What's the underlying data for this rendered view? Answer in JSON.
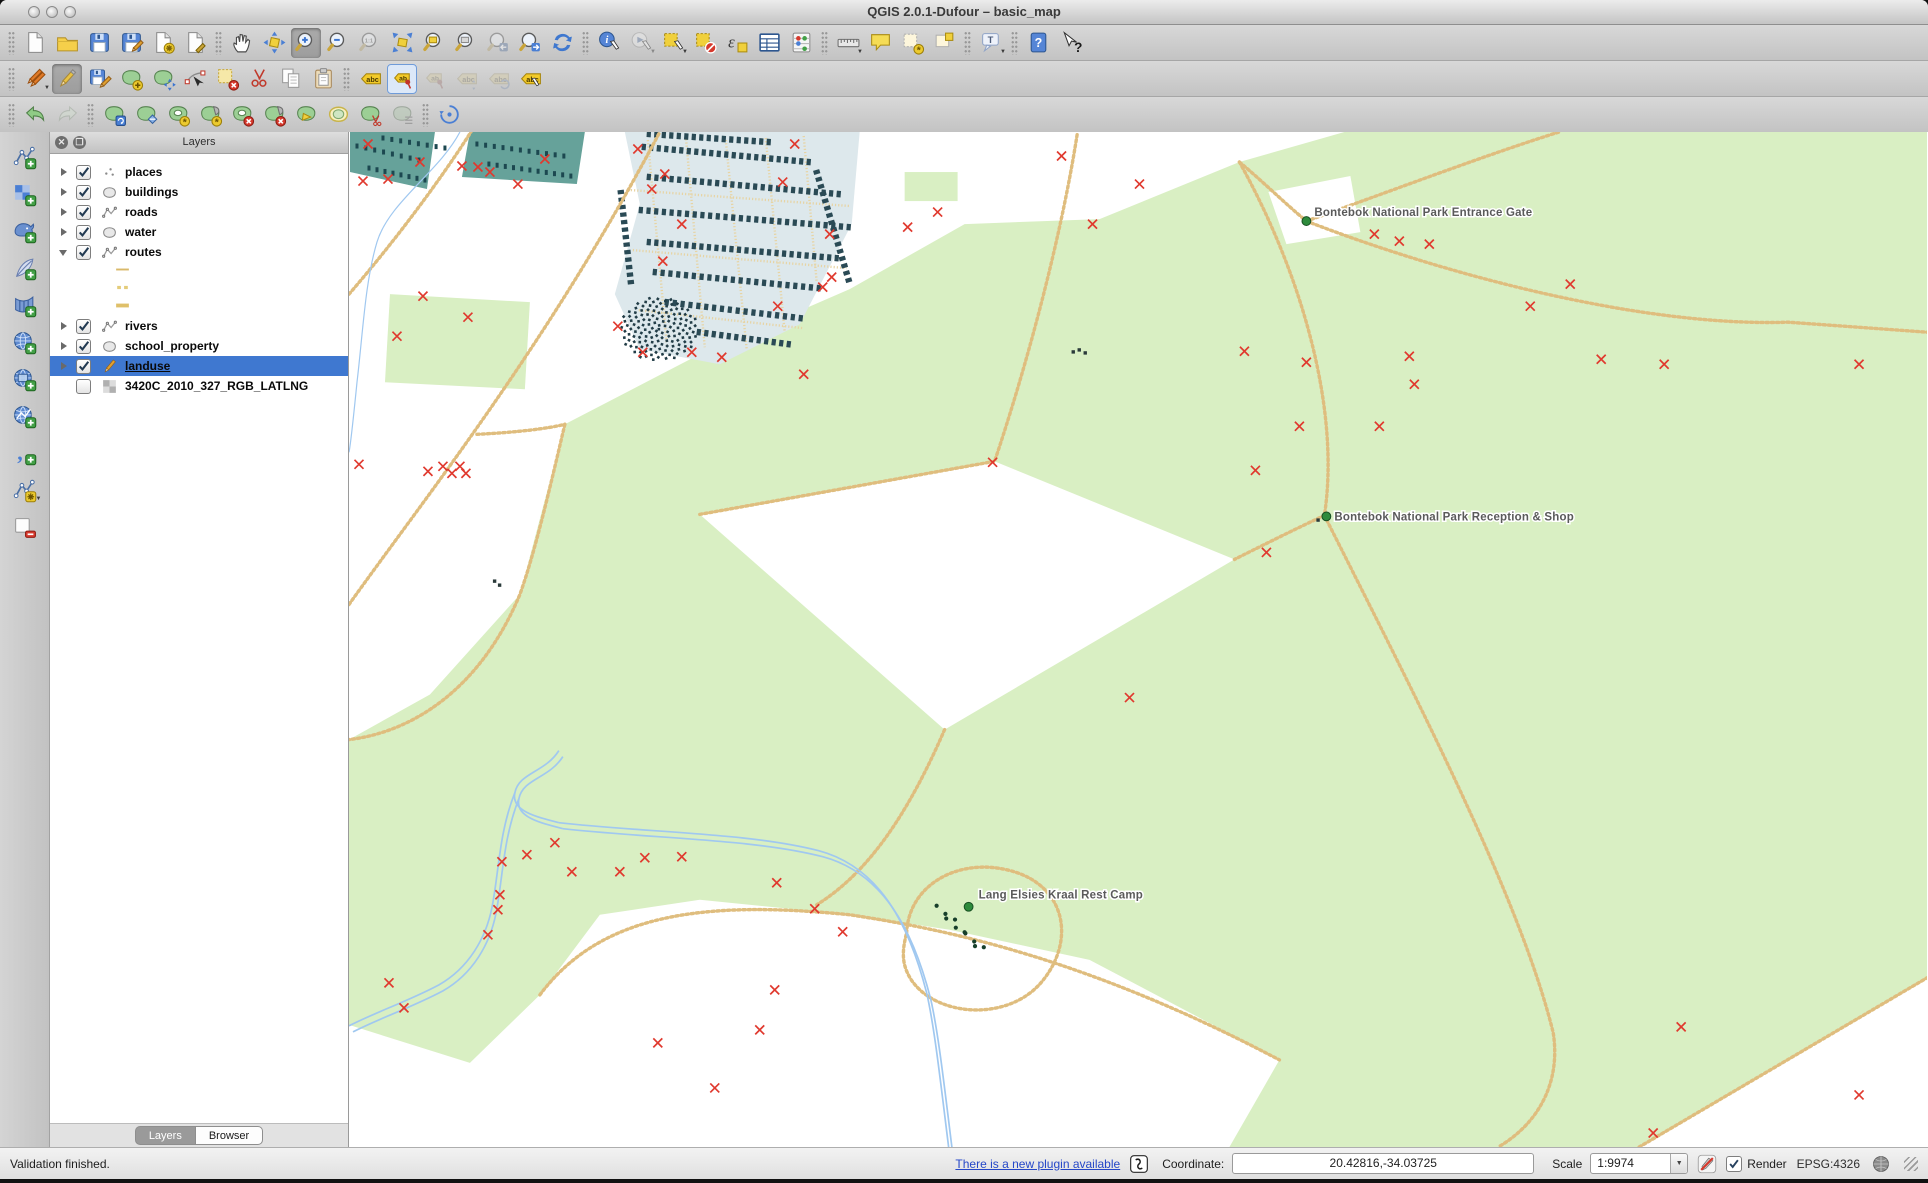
{
  "window": {
    "title": "QG­IS 2.0.1-Dufour – basic_map"
  },
  "toolbars": {
    "row1": [
      "|",
      "new-project",
      "open-project",
      "save-project",
      "save-project-as",
      "new-print-composer",
      "composer-manager",
      "|",
      "pan-map",
      "pan-to-selection",
      "zoom-in",
      "zoom-out",
      "zoom-actual-size",
      "zoom-full-extent",
      "zoom-to-selection",
      "zoom-to-layer",
      "zoom-last",
      "zoom-next",
      "refresh-map",
      "|",
      "identify-features",
      "run-feature-action",
      "select-features",
      "deselect-features",
      "select-by-expression",
      "open-attribute-table",
      "field-calculator",
      "|",
      "measure-line",
      "map-tips",
      "new-bookmark",
      "show-bookmarks",
      "|",
      "text-annotation",
      "|",
      "help-contents",
      "whats-this"
    ],
    "row2": [
      "|",
      "current-edits",
      "toggle-editing",
      "save-layer-edits",
      "add-feature",
      "move-feature",
      "node-tool",
      "delete-selected",
      "cut-features",
      "copy-features",
      "paste-features",
      "|",
      "labeling-options",
      "pin-unpin-labels",
      "highlight-pinned-labels",
      "move-label",
      "rotate-label",
      "change-label"
    ],
    "row3": [
      "|",
      "undo",
      "redo",
      "|",
      "rotate-feature",
      "simplify-feature",
      "add-ring",
      "add-part",
      "delete-ring",
      "delete-part",
      "reshape-features",
      "offset-curve",
      "split-features",
      "merge-features",
      "|",
      "rotate-point-symbols"
    ],
    "left": [
      "add-vector-layer",
      "add-raster-layer",
      "add-postgis-layer",
      "add-spatialite-layer",
      "add-mssql-layer",
      "add-wms-layer",
      "add-wcs-layer",
      "add-wfs-layer",
      "add-delimited-text-layer",
      "new-shapefile-layer",
      "remove-layer"
    ],
    "states": {
      "pressed": [
        "zoom-in",
        "toggle-editing"
      ],
      "framed": [
        "pin-unpin-labels"
      ],
      "disabled": [
        "zoom-actual-size",
        "zoom-last",
        "run-feature-action",
        "highlight-pinned-labels",
        "move-label",
        "rotate-label",
        "redo",
        "merge-features"
      ],
      "dropdown": [
        "current-edits",
        "run-feature-action",
        "select-features",
        "measure-line",
        "text-annotation",
        "new-shapefile-layer"
      ]
    }
  },
  "layers_panel": {
    "title": "Layers",
    "items": [
      {
        "label": "places",
        "checked": true,
        "arrow": "right",
        "symbol": "points"
      },
      {
        "label": "buildings",
        "checked": true,
        "arrow": "right",
        "symbol": "polygon"
      },
      {
        "label": "roads",
        "checked": true,
        "arrow": "right",
        "symbol": "line"
      },
      {
        "label": "water",
        "checked": true,
        "arrow": "right",
        "symbol": "polygon"
      },
      {
        "label": "routes",
        "checked": true,
        "arrow": "down",
        "symbol": "line",
        "children": [
          {
            "swatch": "thin"
          },
          {
            "swatch": "dashed"
          },
          {
            "swatch": "thick"
          }
        ]
      },
      {
        "label": "rivers",
        "checked": true,
        "arrow": "right",
        "symbol": "line"
      },
      {
        "label": "school_property",
        "checked": true,
        "arrow": "right",
        "symbol": "polygon"
      },
      {
        "label": "landuse",
        "checked": true,
        "arrow": "right",
        "symbol": "pencil",
        "selected": true
      },
      {
        "label": "3420C_2010_327_RGB_LATLNG",
        "checked": false,
        "symbol": "raster"
      }
    ],
    "tabs": [
      {
        "label": "Layers",
        "active": true
      },
      {
        "label": "Browser",
        "active": false
      }
    ]
  },
  "map": {
    "labels": [
      {
        "text": "Bontebok National Park Entrance Gate",
        "x": 966,
        "y": 84,
        "dot_x": 958,
        "dot_y": 89
      },
      {
        "text": "Bontebok National Park Reception & Shop",
        "x": 986,
        "y": 388,
        "dot_x": 978,
        "dot_y": 384
      },
      {
        "text": "Lang Elsies Kraal Rest Camp",
        "x": 630,
        "y": 766,
        "dot_x": 620,
        "dot_y": 774
      }
    ],
    "markers": [
      [
        19,
        12
      ],
      [
        14,
        49
      ],
      [
        39,
        47
      ],
      [
        71,
        30
      ],
      [
        113,
        34
      ],
      [
        129,
        35
      ],
      [
        141,
        40
      ],
      [
        169,
        52
      ],
      [
        196,
        27
      ],
      [
        74,
        164
      ],
      [
        119,
        185
      ],
      [
        48,
        204
      ],
      [
        289,
        17
      ],
      [
        316,
        42
      ],
      [
        303,
        57
      ],
      [
        333,
        92
      ],
      [
        314,
        129
      ],
      [
        269,
        194
      ],
      [
        294,
        220
      ],
      [
        343,
        220
      ],
      [
        373,
        225
      ],
      [
        429,
        174
      ],
      [
        434,
        50
      ],
      [
        446,
        12
      ],
      [
        481,
        102
      ],
      [
        474,
        155
      ],
      [
        483,
        145
      ],
      [
        10,
        332
      ],
      [
        79,
        339
      ],
      [
        94,
        334
      ],
      [
        103,
        341
      ],
      [
        111,
        334
      ],
      [
        117,
        341
      ],
      [
        455,
        242
      ],
      [
        644,
        330
      ],
      [
        781,
        565
      ],
      [
        918,
        420
      ],
      [
        559,
        95
      ],
      [
        589,
        80
      ],
      [
        713,
        24
      ],
      [
        744,
        92
      ],
      [
        791,
        52
      ],
      [
        1026,
        102
      ],
      [
        1051,
        109
      ],
      [
        1081,
        112
      ],
      [
        896,
        219
      ],
      [
        958,
        230
      ],
      [
        1061,
        224
      ],
      [
        1066,
        252
      ],
      [
        951,
        294
      ],
      [
        1031,
        294
      ],
      [
        1253,
        227
      ],
      [
        1316,
        232
      ],
      [
        1511,
        232
      ],
      [
        907,
        338
      ],
      [
        1182,
        174
      ],
      [
        1222,
        152
      ],
      [
        153,
        729
      ],
      [
        178,
        722
      ],
      [
        206,
        710
      ],
      [
        223,
        739
      ],
      [
        271,
        739
      ],
      [
        296,
        725
      ],
      [
        333,
        724
      ],
      [
        428,
        750
      ],
      [
        466,
        776
      ],
      [
        494,
        799
      ],
      [
        151,
        762
      ],
      [
        149,
        777
      ],
      [
        139,
        802
      ],
      [
        426,
        857
      ],
      [
        411,
        897
      ],
      [
        40,
        850
      ],
      [
        55,
        875
      ],
      [
        309,
        910
      ],
      [
        366,
        955
      ],
      [
        1333,
        894
      ],
      [
        1305,
        1000
      ],
      [
        1511,
        962
      ]
    ],
    "colors": {
      "park": "#d9efc3",
      "town": "#66a29a",
      "residential": "#dde8ec",
      "building": "#2a4a55",
      "road": "#dfbd7e",
      "street": "#e7d4a4",
      "river": "#a0c8f0",
      "marker": "#e0392e",
      "label": "#5a5a5a",
      "poi": "#2e8b3c",
      "selection": "#3f78d0"
    }
  },
  "status_bar": {
    "message": "Validation finished.",
    "plugin_link": "There is a new plugin available",
    "coordinate_label": "Coordinate:",
    "coordinate_value": "20.42816,-34.03725",
    "scale_label": "Scale",
    "scale_value": "1:9974",
    "render_label": "Render",
    "crs": "EPSG:4326"
  }
}
